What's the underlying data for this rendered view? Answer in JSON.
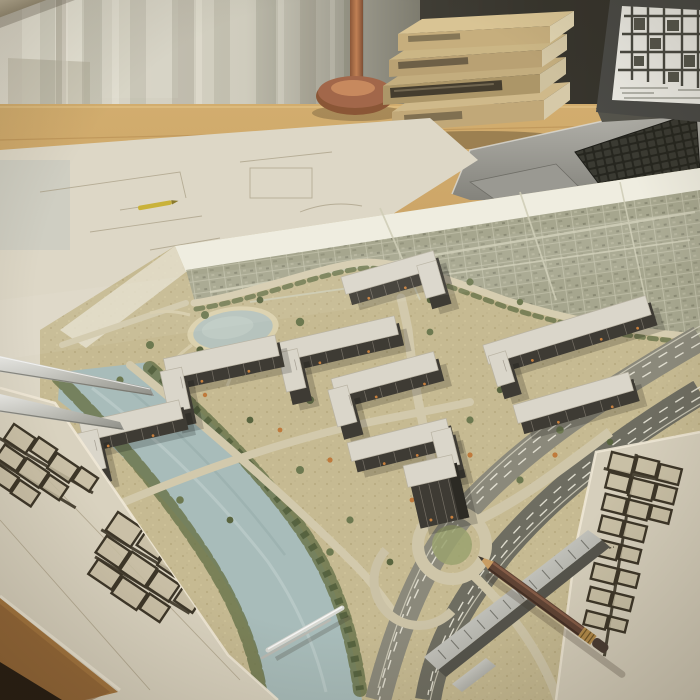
{
  "meta": {
    "type": "photograph",
    "subject": "Architect's desk with an aerial masterplan render, blueprints and drafting tools"
  },
  "palette": {
    "curtain_light": "#dcd8ca",
    "wall_dark": "#37352d",
    "desk_wood": "#c49a5e",
    "paper_cream": "#ddd6c3",
    "map_terrain": "#c6ba92",
    "city_fabric": "#a6a68e",
    "river_water": "#a8bcba",
    "building_dark": "#3e3b34",
    "roof_light": "#dad6ca",
    "tree_green": "#6d7950",
    "autumn_orange": "#bf7a3c",
    "asphalt_dark": "#6e6d61",
    "copper_lamp": "#a2674a",
    "book_tan": "#c1a878",
    "pencil_brown": "#5f4334",
    "metal_silver": "#c9c9c3"
  },
  "objects": {
    "window_curtains": {
      "label": "sheer curtains over a bright window"
    },
    "desk": {
      "label": "warm wooden drafting desk"
    },
    "desk_lamp": {
      "label": "copper desk lamp base and pole"
    },
    "books": {
      "label": "stack of four tan hardcover books",
      "count": 4,
      "spine_text": "illegible"
    },
    "laptop": {
      "label": "silver laptop displaying a floor-plan grid drawing",
      "screen_content": "black-and-white urban block floor plan"
    },
    "rolled_blueprint": {
      "label": "rolled-up blueprint sheet covered in plan linework"
    },
    "masterplan_map": {
      "label": "aerial masterplan render of a riverside housing development",
      "buildings_count": 9,
      "features": [
        "existing city fabric",
        "oval pond with park paths",
        "tree-lined river",
        "multi-lane highway corridor",
        "roundabout interchange",
        "dark mid-rise apartment blocks with light roofs",
        "autumn orange trees"
      ]
    },
    "sketch_sheet_left": {
      "label": "cream sheet with hand-drawn floor-plan blocks"
    },
    "sketch_sheet_right": {
      "label": "cream sheet with hand-drawn floor-plan blocks and illegible notes"
    },
    "pencil": {
      "label": "brown wooden pencil with brass ferrule"
    },
    "scale_ruler": {
      "label": "metal scale ruler lying across the plans"
    },
    "drafting_tools": {
      "label": "metal drafting instruments"
    }
  }
}
